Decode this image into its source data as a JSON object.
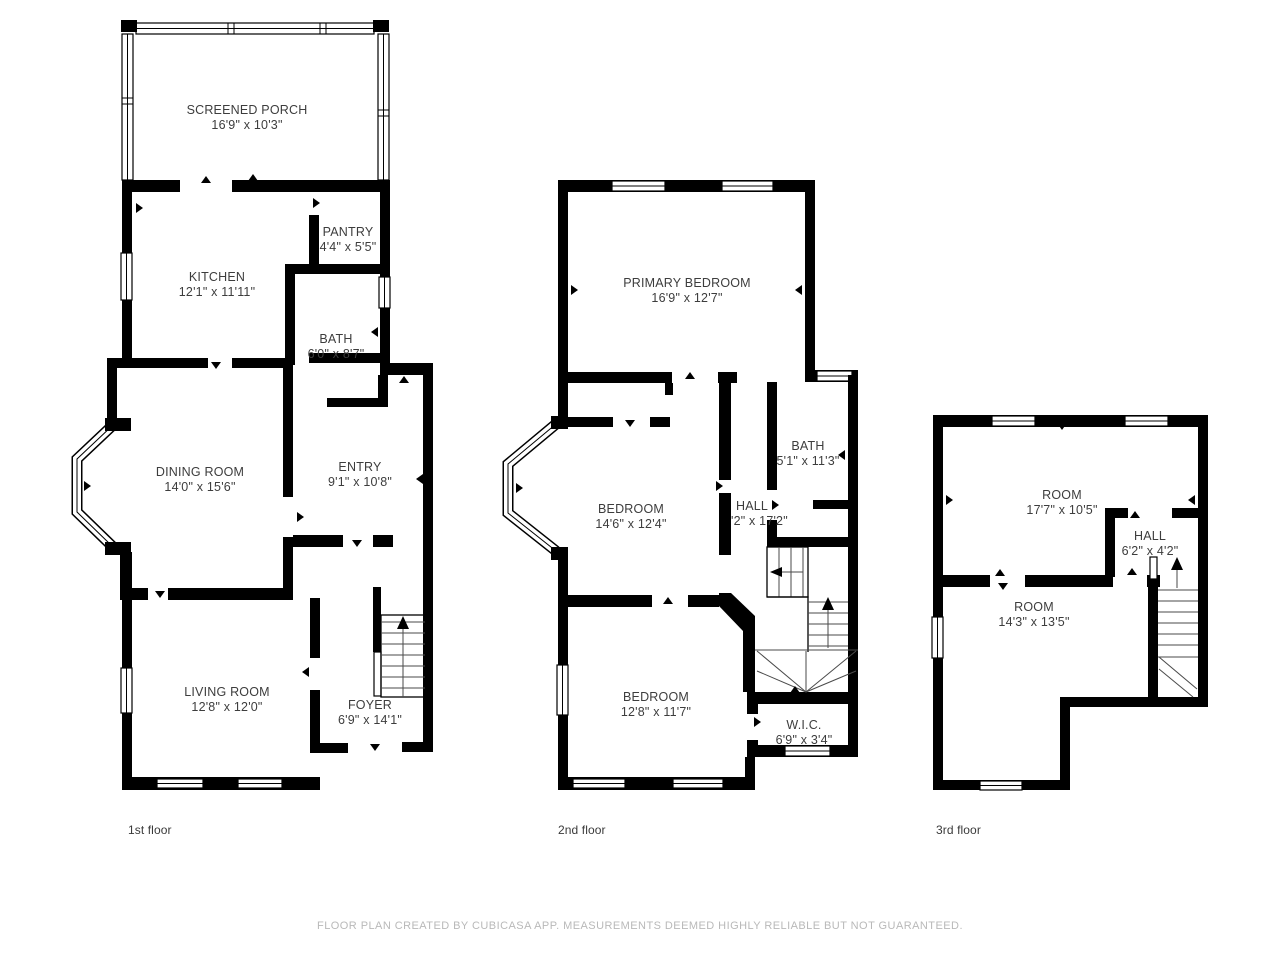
{
  "meta": {
    "footer": "FLOOR PLAN CREATED BY CUBICASA APP. MEASUREMENTS DEEMED HIGHLY RELIABLE BUT NOT GUARANTEED."
  },
  "colors": {
    "background": "#ffffff",
    "wall": "#000000",
    "label": "#3d3d3d",
    "footer": "#b9b9b9"
  },
  "floors": [
    {
      "label": "1st floor",
      "rooms": [
        {
          "name": "SCREENED PORCH",
          "dims": "16'9\" x 10'3\""
        },
        {
          "name": "KITCHEN",
          "dims": "12'1\" x 11'11\""
        },
        {
          "name": "PANTRY",
          "dims": "4'4\" x 5'5\""
        },
        {
          "name": "BATH",
          "dims": "6'0\" x 8'7\""
        },
        {
          "name": "DINING ROOM",
          "dims": "14'0\" x 15'6\""
        },
        {
          "name": "ENTRY",
          "dims": "9'1\" x 10'8\""
        },
        {
          "name": "LIVING ROOM",
          "dims": "12'8\" x 12'0\""
        },
        {
          "name": "FOYER",
          "dims": "6'9\" x 14'1\""
        }
      ]
    },
    {
      "label": "2nd floor",
      "rooms": [
        {
          "name": "PRIMARY BEDROOM",
          "dims": "16'9\" x 12'7\""
        },
        {
          "name": "BATH",
          "dims": "5'1\" x 11'3\""
        },
        {
          "name": "BEDROOM",
          "dims": "14'6\" x 12'4\""
        },
        {
          "name": "HALL",
          "dims": "'2\" x 17'2\""
        },
        {
          "name": "BEDROOM",
          "dims": "12'8\" x 11'7\""
        },
        {
          "name": "W.I.C.",
          "dims": "6'9\" x 3'4\""
        }
      ]
    },
    {
      "label": "3rd floor",
      "rooms": [
        {
          "name": "ROOM",
          "dims": "17'7\" x 10'5\""
        },
        {
          "name": "HALL",
          "dims": "6'2\" x 4'2\""
        },
        {
          "name": "ROOM",
          "dims": "14'3\" x 13'5\""
        }
      ]
    }
  ]
}
